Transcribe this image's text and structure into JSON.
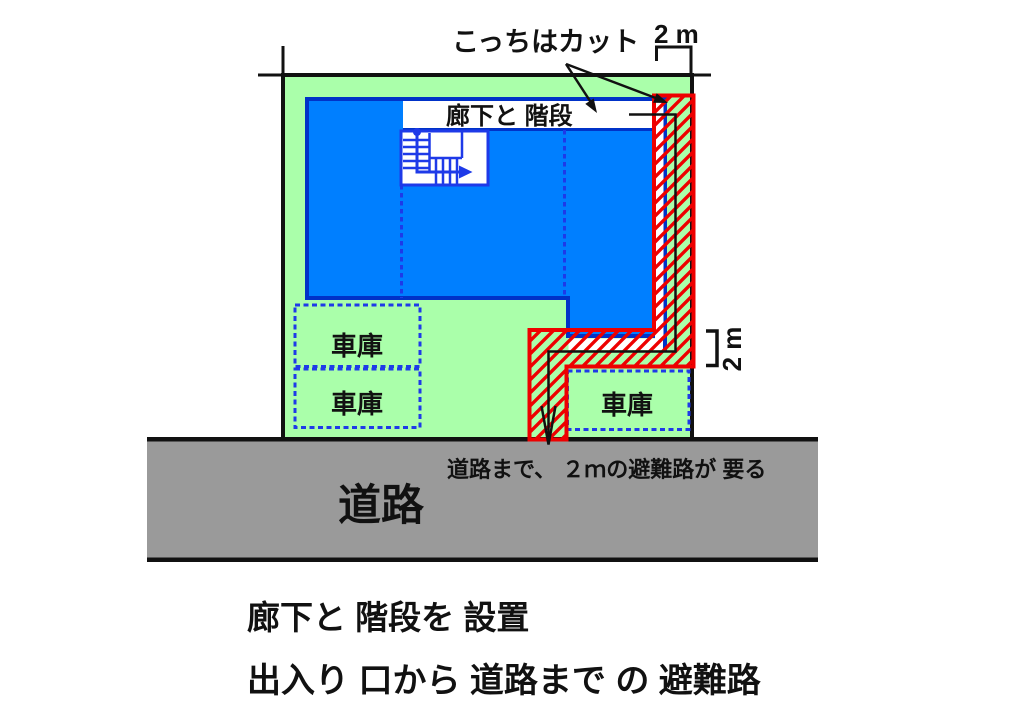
{
  "diagram": {
    "annotations": {
      "cut_label": "こっちはカット",
      "dim_top": "2 m",
      "dim_right": "2 m",
      "road_note": "道路まで、 ２ｍの避難路が 要る",
      "caption_line1": "廊下と 階段を 設置",
      "caption_line2": "出入り 口から 道路まで の 避難路"
    },
    "labels": {
      "corridor": "廊下と 階段",
      "road": "道路",
      "garages": [
        "車庫",
        "車庫",
        "車庫"
      ]
    },
    "icons": {
      "cut_pointer_arrows": "arrow-icon",
      "escape_route_arrow": "down-arrow-icon",
      "stair_direction_arrow": "right-arrow-icon"
    },
    "colors": {
      "plot_green": "#aaffaa",
      "building_fill": "#007fff",
      "building_border": "#0032c8",
      "line_blue": "#1e3ae8",
      "hatch_red": "#ee0000",
      "road_gray": "#9a9a9a",
      "ink": "#111111"
    }
  }
}
